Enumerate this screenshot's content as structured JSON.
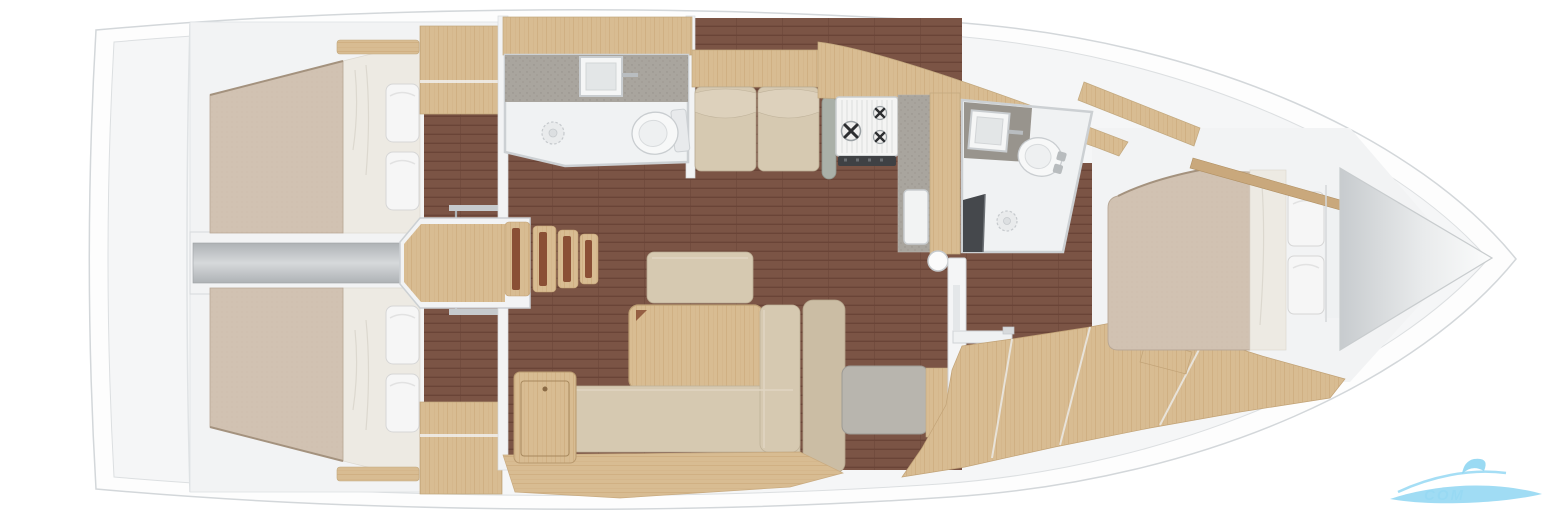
{
  "image": {
    "type": "sailboat-interior-floor-plan",
    "view": "top-down-3d-render",
    "orientation": "bow-right"
  },
  "watermark": {
    "text": "COM"
  },
  "rooms": [
    {
      "name": "aft-cabin-port",
      "fixtures": [
        "double-berth",
        "two-pillows",
        "wardrobe",
        "shelf",
        "door-rail"
      ]
    },
    {
      "name": "aft-cabin-starboard",
      "fixtures": [
        "double-berth",
        "two-pillows",
        "wardrobe",
        "shelf",
        "door-rail"
      ]
    },
    {
      "name": "engine-corridor",
      "fixtures": [
        "engine-compartment-cover"
      ]
    },
    {
      "name": "companionway",
      "fixtures": [
        "wood-landing",
        "four-steps"
      ]
    },
    {
      "name": "aft-head",
      "fixtures": [
        "counter",
        "sink",
        "toilet",
        "shower-drain"
      ]
    },
    {
      "name": "salon",
      "fixtures": [
        "settee-two-cushions",
        "bench",
        "table",
        "l-sofa",
        "storage-cabinet",
        "plinth",
        "grab-post"
      ]
    },
    {
      "name": "galley",
      "fixtures": [
        "three-burner-stove",
        "oven",
        "counter",
        "sink",
        "compression-post"
      ]
    },
    {
      "name": "nav-station",
      "fixtures": [
        "seat",
        "partition",
        "chart-table"
      ]
    },
    {
      "name": "forward-head",
      "fixtures": [
        "counter",
        "sink",
        "toilet",
        "shower-drain",
        "dark-bench"
      ]
    },
    {
      "name": "forward-cabin",
      "fixtures": [
        "double-berth",
        "two-pillows",
        "hull-shelves",
        "step",
        "lockers"
      ]
    },
    {
      "name": "bow",
      "fixtures": [
        "anchor-locker"
      ]
    }
  ],
  "colors": {
    "hull_line": "#d3d7da",
    "hull_fill": "#fdfdfd",
    "deck_fill": "#f5f6f7",
    "wall_fill": "#f2f3f4",
    "wall_line": "#ccd0d3",
    "floor_dark": "#7b5445",
    "floor_dark_line": "#6a4437",
    "wood": "#d8bc92",
    "wood_grain": "#c6a272",
    "wood_dark": "#8a4f35",
    "mattress": "#d1c2b2",
    "mattress_line": "#b3a290",
    "sheet": "#edeae3",
    "pillow": "#f6f6f6",
    "cushion": "#d6c9b1",
    "cushion_light": "#ddd1bc",
    "cushion_dark": "#cbbda4",
    "counter_gray": "#a9a59e",
    "counter_dark": "#96918a",
    "seat_gray": "#b8b5ae",
    "fixture_white": "#f0f2f3",
    "bench_dark": "#45484c",
    "engine_gray": "#b7bbbe",
    "engine_light": "#d2d5d7",
    "post_gray": "#aab0a8",
    "watermark_blue": "#8fd6f2",
    "watermark_light": "#c4ecf9"
  }
}
